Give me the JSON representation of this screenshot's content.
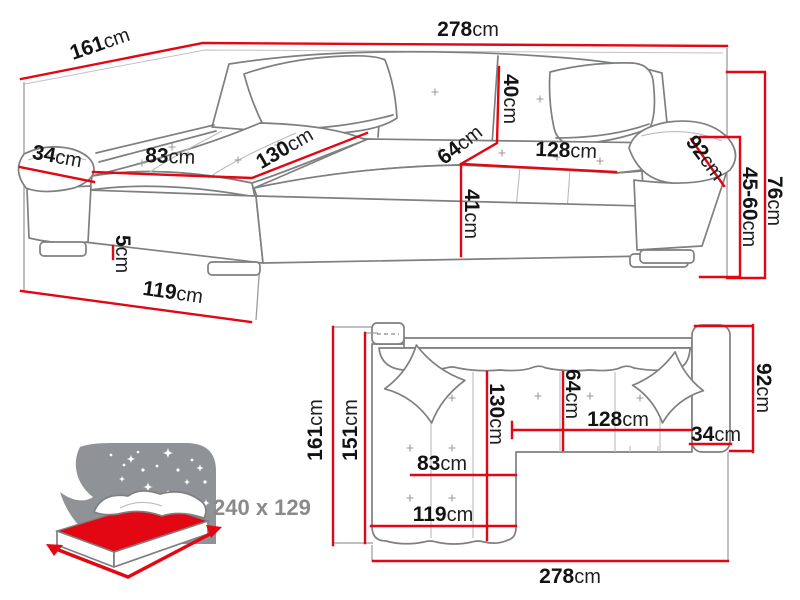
{
  "diagram": {
    "unit": "cm",
    "perspective_view": {
      "total_width": "278",
      "total_depth": "161",
      "backrest_height": "40",
      "seat_depth": "64",
      "seat_length": "128",
      "armrest_depth": "92",
      "armrest_height_range": "45-60",
      "total_height": "76",
      "seat_height": "41",
      "armrest_width": "34",
      "chaise_seat_width": "83",
      "chaise_seat_length": "130",
      "leg_height": "5",
      "chaise_depth": "119"
    },
    "top_view": {
      "total_depth": "161",
      "body_depth": "151",
      "chaise_seat_length": "130",
      "seat_depth": "64",
      "seat_length": "128",
      "armrest_width": "34",
      "armrest_depth": "92",
      "chaise_seat_width": "83",
      "chaise_depth": "119",
      "total_width": "278"
    },
    "sleeping_function": {
      "bed_size": "240 x 129"
    },
    "colors": {
      "dimension_red": "#e30613",
      "outline_gray": "#7f7f7f",
      "label_black": "#131313",
      "muted_gray": "#8a8a8a"
    }
  }
}
